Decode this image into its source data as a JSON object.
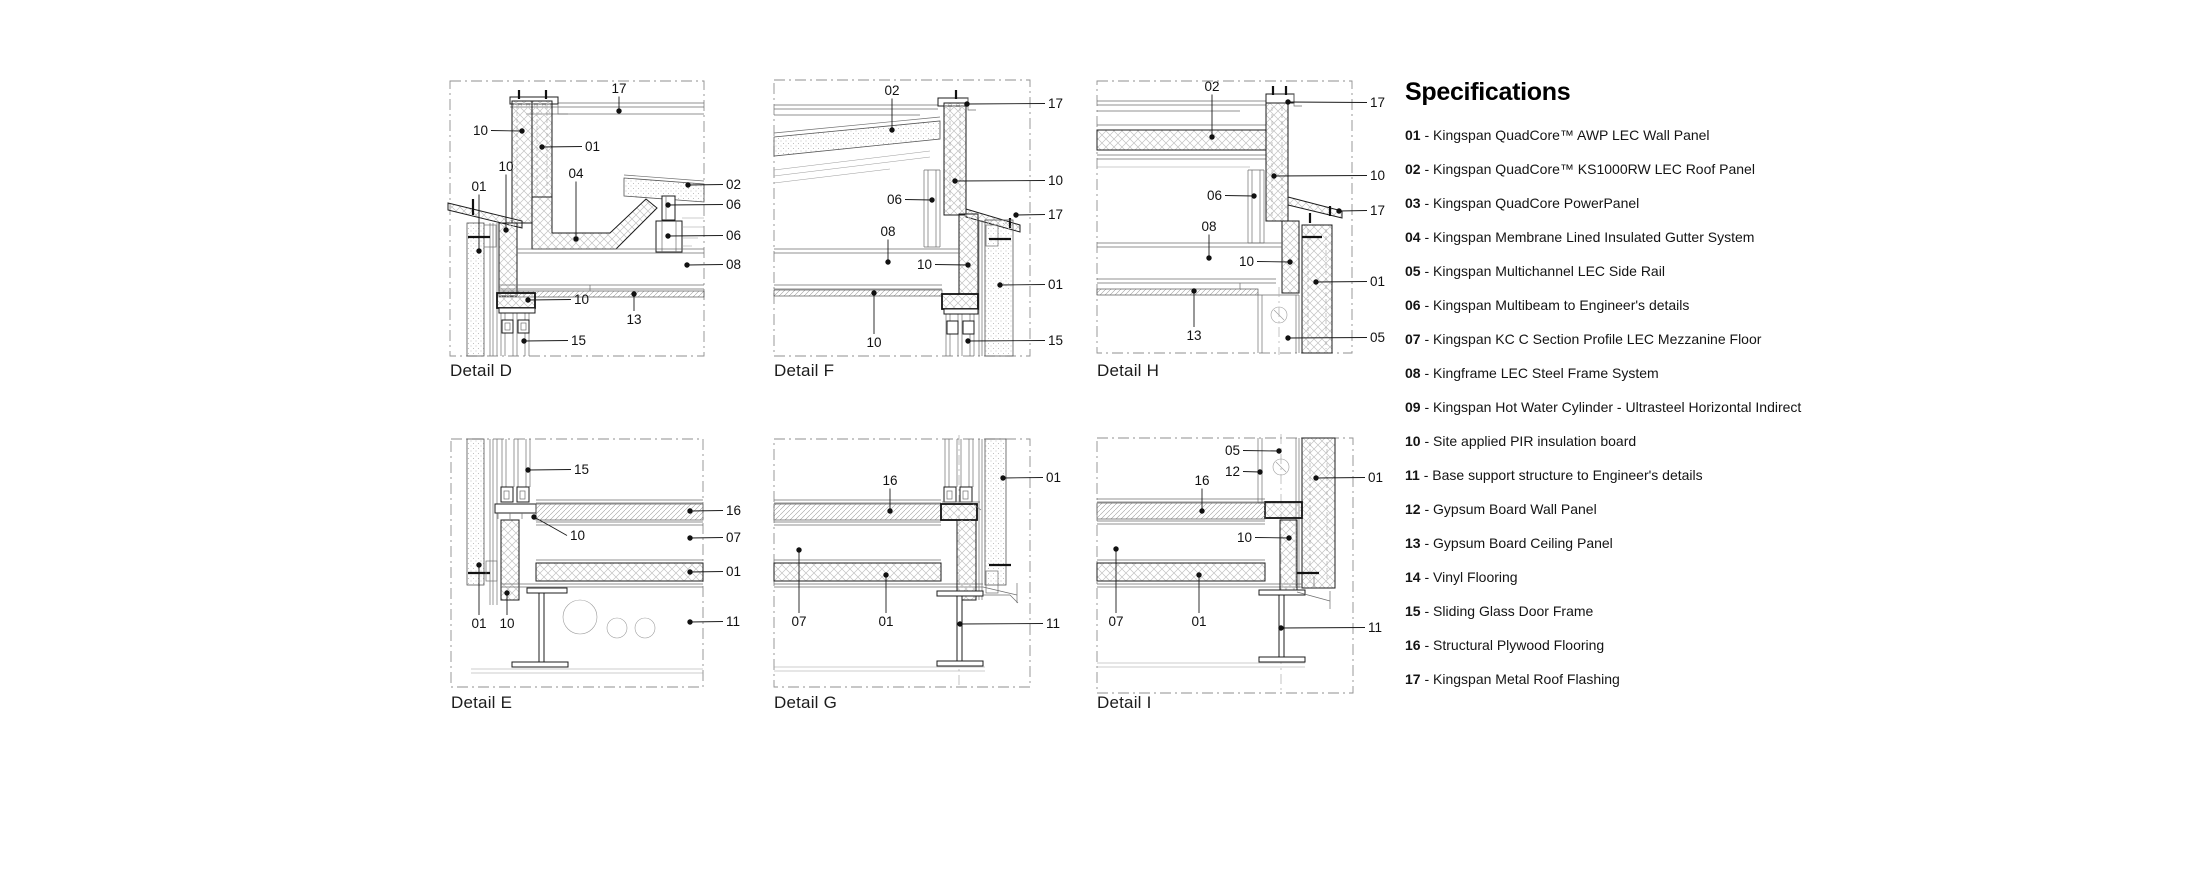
{
  "specifications": {
    "title": "Specifications",
    "separator": " - ",
    "items": [
      {
        "num": "01",
        "text": "Kingspan QuadCore™ AWP LEC Wall Panel"
      },
      {
        "num": "02",
        "text": "Kingspan QuadCore™ KS1000RW LEC Roof Panel"
      },
      {
        "num": "03",
        "text": "Kingspan QuadCore PowerPanel"
      },
      {
        "num": "04",
        "text": "Kingspan Membrane Lined Insulated Gutter System"
      },
      {
        "num": "05",
        "text": "Kingspan Multichannel LEC Side Rail"
      },
      {
        "num": "06",
        "text": "Kingspan Multibeam to Engineer's details"
      },
      {
        "num": "07",
        "text": "Kingspan KC C Section Profile LEC Mezzanine Floor"
      },
      {
        "num": "08",
        "text": "Kingframe LEC Steel Frame System"
      },
      {
        "num": "09",
        "text": "Kingspan Hot Water Cylinder - Ultrasteel Horizontal Indirect"
      },
      {
        "num": "10",
        "text": "Site applied PIR insulation board"
      },
      {
        "num": "11",
        "text": "Base support structure to Engineer's details"
      },
      {
        "num": "12",
        "text": "Gypsum Board Wall Panel"
      },
      {
        "num": "13",
        "text": "Gypsum Board Ceiling Panel"
      },
      {
        "num": "14",
        "text": "Vinyl Flooring"
      },
      {
        "num": "15",
        "text": "Sliding Glass Door Frame"
      },
      {
        "num": "16",
        "text": "Structural Plywood Flooring"
      },
      {
        "num": "17",
        "text": "Kingspan Metal Roof Flashing"
      }
    ]
  },
  "details": [
    {
      "id": "D",
      "label": "Detail D",
      "callouts": [
        {
          "label": "17",
          "anchor": "middle",
          "lx": 179,
          "ly": 18,
          "dx": 179,
          "dy": 36
        },
        {
          "label": "10",
          "anchor": "end",
          "lx": 48,
          "ly": 60,
          "dx": 82,
          "dy": 56
        },
        {
          "label": "01",
          "anchor": "start",
          "lx": 145,
          "ly": 76,
          "dx": 102,
          "dy": 72
        },
        {
          "label": "10",
          "anchor": "middle",
          "lx": 66,
          "ly": 96,
          "dx": 66,
          "dy": 155
        },
        {
          "label": "01",
          "anchor": "middle",
          "lx": 39,
          "ly": 116,
          "dx": 39,
          "dy": 176
        },
        {
          "label": "04",
          "anchor": "middle",
          "lx": 136,
          "ly": 103,
          "dx": 136,
          "dy": 164
        },
        {
          "label": "02",
          "anchor": "start",
          "lx": 286,
          "ly": 114,
          "dx": 248,
          "dy": 110
        },
        {
          "label": "06",
          "anchor": "start",
          "lx": 286,
          "ly": 134,
          "dx": 228,
          "dy": 130
        },
        {
          "label": "06",
          "anchor": "start",
          "lx": 286,
          "ly": 165,
          "dx": 228,
          "dy": 161
        },
        {
          "label": "08",
          "anchor": "start",
          "lx": 286,
          "ly": 194,
          "dx": 247,
          "dy": 190
        },
        {
          "label": "10",
          "anchor": "start",
          "lx": 134,
          "ly": 229,
          "dx": 88,
          "dy": 225
        },
        {
          "label": "13",
          "anchor": "middle",
          "lx": 194,
          "ly": 249,
          "dx": 194,
          "dy": 219
        },
        {
          "label": "15",
          "anchor": "start",
          "lx": 131,
          "ly": 270,
          "dx": 84,
          "dy": 266
        }
      ]
    },
    {
      "id": "F",
      "label": "Detail F",
      "callouts": [
        {
          "label": "02",
          "anchor": "middle",
          "lx": 122,
          "ly": 20,
          "dx": 122,
          "dy": 55
        },
        {
          "label": "17",
          "anchor": "start",
          "lx": 278,
          "ly": 33,
          "dx": 197,
          "dy": 29
        },
        {
          "label": "10",
          "anchor": "start",
          "lx": 278,
          "ly": 110,
          "dx": 185,
          "dy": 106
        },
        {
          "label": "17",
          "anchor": "start",
          "lx": 278,
          "ly": 144,
          "dx": 246,
          "dy": 140
        },
        {
          "label": "06",
          "anchor": "end",
          "lx": 132,
          "ly": 129,
          "dx": 162,
          "dy": 125
        },
        {
          "label": "08",
          "anchor": "middle",
          "lx": 118,
          "ly": 161,
          "dx": 118,
          "dy": 187
        },
        {
          "label": "10",
          "anchor": "end",
          "lx": 162,
          "ly": 194,
          "dx": 198,
          "dy": 190
        },
        {
          "label": "01",
          "anchor": "start",
          "lx": 278,
          "ly": 214,
          "dx": 230,
          "dy": 210
        },
        {
          "label": "10",
          "anchor": "middle",
          "lx": 104,
          "ly": 272,
          "dx": 104,
          "dy": 218
        },
        {
          "label": "15",
          "anchor": "start",
          "lx": 278,
          "ly": 270,
          "dx": 198,
          "dy": 266
        }
      ]
    },
    {
      "id": "H",
      "label": "Detail H",
      "callouts": [
        {
          "label": "02",
          "anchor": "middle",
          "lx": 122,
          "ly": 16,
          "dx": 122,
          "dy": 62
        },
        {
          "label": "17",
          "anchor": "start",
          "lx": 280,
          "ly": 32,
          "dx": 198,
          "dy": 27
        },
        {
          "label": "10",
          "anchor": "start",
          "lx": 280,
          "ly": 105,
          "dx": 184,
          "dy": 101
        },
        {
          "label": "17",
          "anchor": "start",
          "lx": 280,
          "ly": 140,
          "dx": 249,
          "dy": 136
        },
        {
          "label": "06",
          "anchor": "end",
          "lx": 132,
          "ly": 125,
          "dx": 164,
          "dy": 121
        },
        {
          "label": "08",
          "anchor": "middle",
          "lx": 119,
          "ly": 156,
          "dx": 119,
          "dy": 183
        },
        {
          "label": "10",
          "anchor": "end",
          "lx": 164,
          "ly": 191,
          "dx": 200,
          "dy": 187
        },
        {
          "label": "01",
          "anchor": "start",
          "lx": 280,
          "ly": 211,
          "dx": 226,
          "dy": 207
        },
        {
          "label": "13",
          "anchor": "middle",
          "lx": 104,
          "ly": 265,
          "dx": 104,
          "dy": 216
        },
        {
          "label": "05",
          "anchor": "start",
          "lx": 280,
          "ly": 267,
          "dx": 198,
          "dy": 263
        }
      ]
    },
    {
      "id": "E",
      "label": "Detail E",
      "callouts": [
        {
          "label": "15",
          "anchor": "start",
          "lx": 134,
          "ly": 49,
          "dx": 88,
          "dy": 45
        },
        {
          "label": "16",
          "anchor": "start",
          "lx": 286,
          "ly": 90,
          "dx": 250,
          "dy": 86
        },
        {
          "label": "10",
          "anchor": "start",
          "lx": 130,
          "ly": 115,
          "dx": 94,
          "dy": 92,
          "elbow": [
            112,
            102
          ]
        },
        {
          "label": "07",
          "anchor": "start",
          "lx": 286,
          "ly": 117,
          "dx": 250,
          "dy": 113
        },
        {
          "label": "01",
          "anchor": "start",
          "lx": 286,
          "ly": 151,
          "dx": 250,
          "dy": 147
        },
        {
          "label": "11",
          "anchor": "start",
          "lx": 286,
          "ly": 201,
          "dx": 250,
          "dy": 197
        },
        {
          "label": "01",
          "anchor": "middle",
          "lx": 39,
          "ly": 203,
          "dx": 39,
          "dy": 140
        },
        {
          "label": "10",
          "anchor": "middle",
          "lx": 67,
          "ly": 203,
          "dx": 67,
          "dy": 168
        }
      ]
    },
    {
      "id": "G",
      "label": "Detail G",
      "callouts": [
        {
          "label": "16",
          "anchor": "middle",
          "lx": 120,
          "ly": 60,
          "dx": 120,
          "dy": 86
        },
        {
          "label": "01",
          "anchor": "start",
          "lx": 276,
          "ly": 57,
          "dx": 233,
          "dy": 53
        },
        {
          "label": "07",
          "anchor": "middle",
          "lx": 29,
          "ly": 201,
          "dx": 29,
          "dy": 125
        },
        {
          "label": "01",
          "anchor": "middle",
          "lx": 116,
          "ly": 201,
          "dx": 116,
          "dy": 150
        },
        {
          "label": "11",
          "anchor": "start",
          "lx": 276,
          "ly": 203,
          "dx": 190,
          "dy": 199
        }
      ]
    },
    {
      "id": "I",
      "label": "Detail I",
      "callouts": [
        {
          "label": "05",
          "anchor": "end",
          "lx": 150,
          "ly": 30,
          "dx": 189,
          "dy": 26
        },
        {
          "label": "12",
          "anchor": "end",
          "lx": 150,
          "ly": 51,
          "dx": 170,
          "dy": 47
        },
        {
          "label": "16",
          "anchor": "middle",
          "lx": 112,
          "ly": 60,
          "dx": 112,
          "dy": 86
        },
        {
          "label": "01",
          "anchor": "start",
          "lx": 278,
          "ly": 57,
          "dx": 226,
          "dy": 53
        },
        {
          "label": "10",
          "anchor": "end",
          "lx": 162,
          "ly": 117,
          "dx": 199,
          "dy": 113
        },
        {
          "label": "07",
          "anchor": "middle",
          "lx": 26,
          "ly": 201,
          "dx": 26,
          "dy": 124
        },
        {
          "label": "01",
          "anchor": "middle",
          "lx": 109,
          "ly": 201,
          "dx": 109,
          "dy": 150
        },
        {
          "label": "11",
          "anchor": "start",
          "lx": 278,
          "ly": 207,
          "dx": 191,
          "dy": 203
        }
      ]
    }
  ]
}
